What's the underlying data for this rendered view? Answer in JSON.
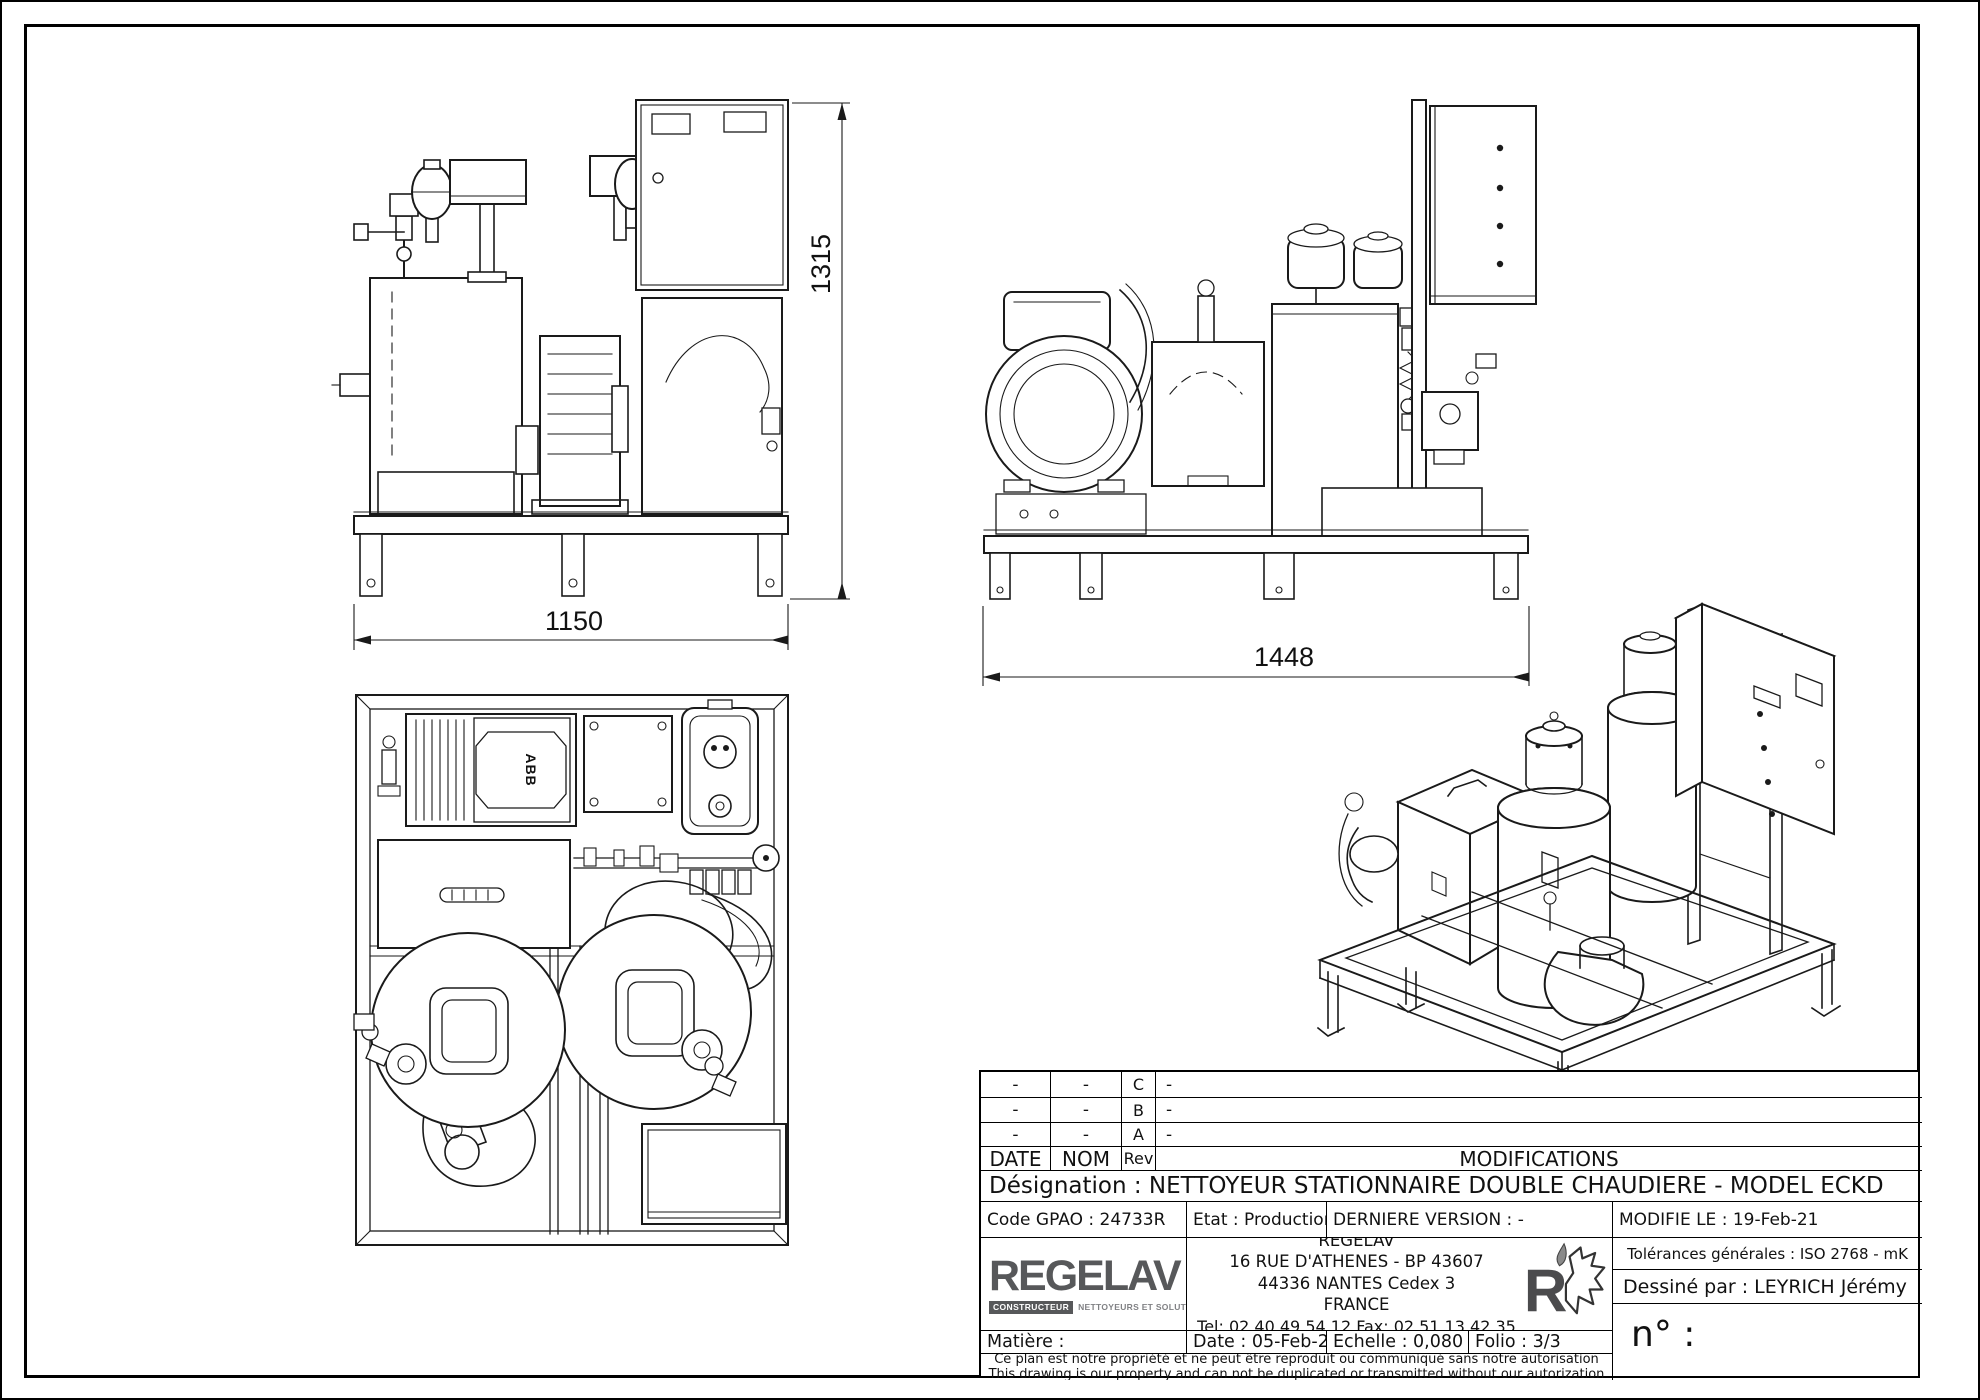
{
  "drawing": {
    "dimensions": {
      "front_width": "1150",
      "front_height": "1315",
      "side_width": "1448"
    },
    "top_view": {
      "motor_label": "ABB"
    }
  },
  "title_block": {
    "revision_table": {
      "headers": {
        "date": "DATE",
        "nom": "NOM",
        "rev": "Rev",
        "modifications": "MODIFICATIONS"
      },
      "rows": [
        {
          "date": "-",
          "nom": "-",
          "rev": "C",
          "modification": "-"
        },
        {
          "date": "-",
          "nom": "-",
          "rev": "B",
          "modification": "-"
        },
        {
          "date": "-",
          "nom": "-",
          "rev": "A",
          "modification": "-"
        }
      ]
    },
    "designation": "Désignation : NETTOYEUR STATIONNAIRE DOUBLE CHAUDIERE - MODEL ECKD",
    "code_gpao": "Code GPAO : 24733R",
    "etat": "Etat : Production",
    "derniere_version": "DERNIERE VERSION : -",
    "modifie_le": "MODIFIE LE : 19-Feb-21",
    "company": {
      "logo_text": "REGELAV",
      "logo_badge": "CONSTRUCTEUR",
      "logo_tagline": "NETTOYEURS ET SOLUTIONS HAUTE PRESSION",
      "address_lines": [
        "REGELAV",
        "16 RUE D'ATHENES - BP 43607",
        "44336 NANTES Cedex 3",
        "FRANCE"
      ],
      "tel_fax": "Tel:   02.40.49.54.12   Fax:   02.51.13.42.35"
    },
    "tolerances": "Tolérances générales : ISO 2768 - mK",
    "dessine_par": "Dessiné par : LEYRICH Jérémy",
    "matiere": "Matière :",
    "date": "Date : 05-Feb-21",
    "echelle": "Echelle : 0,080",
    "folio": "Folio : 3/3",
    "numero": "n° :",
    "disclaimer_fr": "Ce plan est notre propriété et ne peut être reproduit ou communiqué sans notre autorisation",
    "disclaimer_en": "This drawing is our property and can not be duplicated or transmitted without our autorization"
  },
  "colors": {
    "line": "#1a1a1a",
    "logo_gray": "#57585a",
    "badge_gray": "#808184"
  }
}
